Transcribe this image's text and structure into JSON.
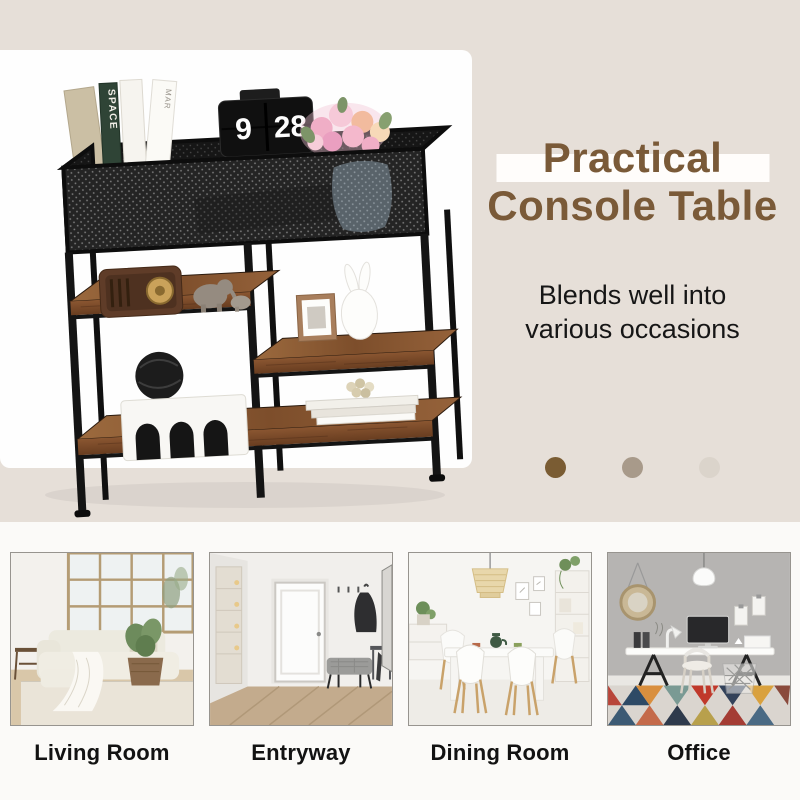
{
  "hero": {
    "title_line1": "Practical",
    "title_line2": "Console Table",
    "subtitle_line1": "Blends well into",
    "subtitle_line2": "various occasions",
    "title_color": "#7a5a38",
    "highlight_bar_color": "#ffffff",
    "clock": {
      "hour": "9",
      "minute": "28"
    },
    "book_spines": {
      "spine1": "SPACE",
      "spine2": "MAR"
    }
  },
  "pager_dots": [
    {
      "color": "#7a5c33"
    },
    {
      "color": "#a89a8a"
    },
    {
      "color": "#dbd4cb"
    }
  ],
  "rooms": [
    {
      "label": "Living Room"
    },
    {
      "label": "Entryway"
    },
    {
      "label": "Dining Room"
    },
    {
      "label": "Office"
    }
  ],
  "background": {
    "top": "#e6dfd8",
    "bottom": "#fbfaf8",
    "panel": "#fefefe"
  }
}
